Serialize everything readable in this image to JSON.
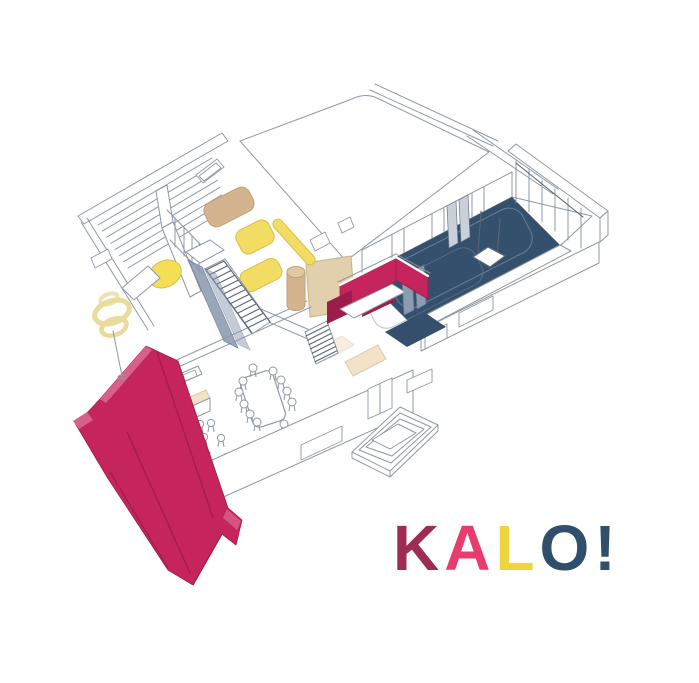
{
  "title": "KALO! axonometric interior floor plan illustration",
  "logo": {
    "letters": [
      {
        "ch": "K",
        "color": "logoMaroon"
      },
      {
        "ch": "A",
        "color": "logoPink"
      },
      {
        "ch": "L",
        "color": "logoYellow"
      },
      {
        "ch": "O",
        "color": "logoNavy"
      },
      {
        "ch": "!",
        "color": "logoNavy"
      }
    ]
  },
  "colors": {
    "line": "#8F97A6",
    "lineDark": "#5A6577",
    "crimson": "#C5255C",
    "crimsonDark": "#9E1C4B",
    "crimsonLight": "#D9608C",
    "navy": "#34506C",
    "rugLine": "#7189A4",
    "slate": "#8B9BB0",
    "slateEdge": "#66788F",
    "curtain": "#C9D0DA",
    "yellow": "#F2DC63",
    "yellowBright": "#F3DE55",
    "yellowEdge": "#D9BE45",
    "yellowPale": "#E9DB9C",
    "tan": "#D3B48E",
    "tanEdge": "#BFA07B",
    "tanLight": "#E3C9A2",
    "beige": "#E2CFAC",
    "beigeEdge": "#C9B38C",
    "cream": "#F2E3C8",
    "creamEdge": "#D9C6A4",
    "logoMaroon": "#9D2D55",
    "logoPink": "#E73C6E",
    "logoYellow": "#EFD43D",
    "logoNavy": "#2F4F6B",
    "background": "#FFFFFF"
  }
}
